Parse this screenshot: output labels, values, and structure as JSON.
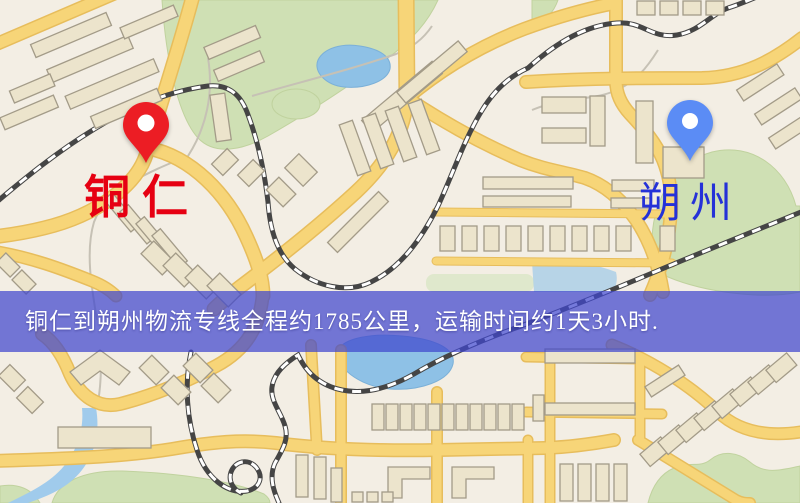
{
  "map": {
    "type": "logistics-route-map",
    "origin_marker": {
      "label": "铜仁",
      "text_color": "#e60012",
      "pin_color": "#ec1d24"
    },
    "destination_marker": {
      "label": "朔州",
      "text_color": "#2531d8",
      "pin_color": "#5b8cf5"
    },
    "banner": {
      "text": "铜仁到朔州物流专线全程约1785公里，运输时间约1天3小时.",
      "background_color": "#4046cd",
      "text_color": "#ffffff"
    },
    "route": {
      "origin": "铜仁",
      "destination": "朔州",
      "distance_km": "1785",
      "duration": "1天3小时"
    },
    "palette": {
      "land": "#f3eee4",
      "road": "#f6d06e",
      "road_casing": "#e9bd58",
      "park": "#cfe0b2",
      "water": "#8cc1e8",
      "building": "#ece4cb",
      "building_outline": "#a39b87",
      "railway": "#454545"
    }
  }
}
